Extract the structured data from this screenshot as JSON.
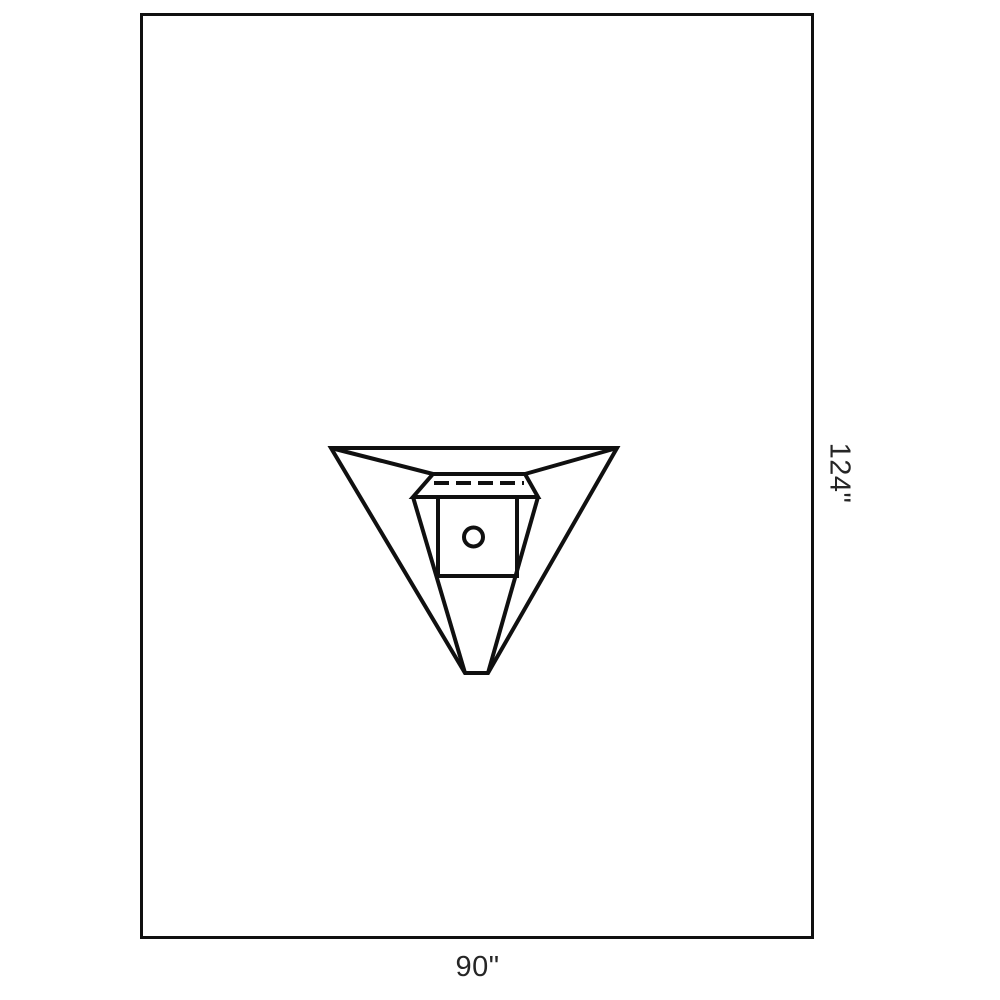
{
  "diagram": {
    "dimension_labels": {
      "width": "90\"",
      "height": "124\""
    },
    "colors": {
      "line": "#101010",
      "label": "#262626",
      "background": "#ffffff"
    },
    "icons": {
      "drain_port": "circle-outline-icon"
    }
  }
}
